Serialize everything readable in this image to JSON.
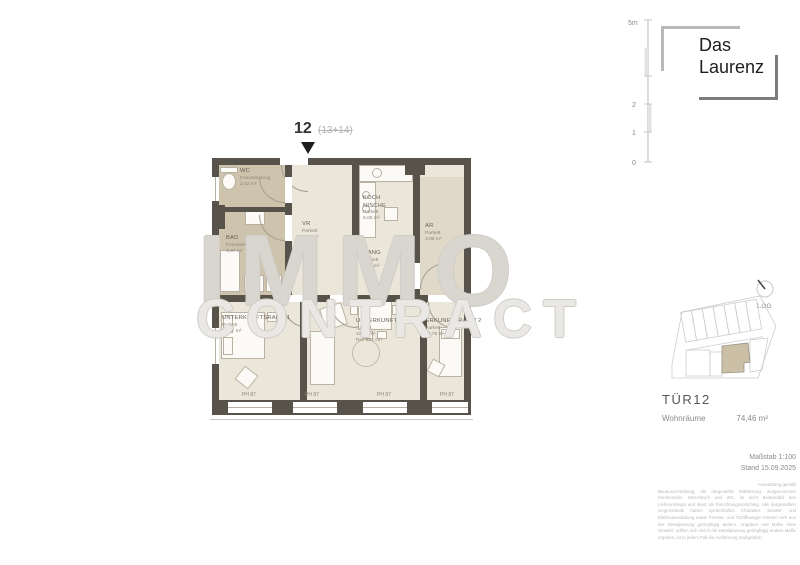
{
  "marker": {
    "unit": "12",
    "combined": "(13+14)"
  },
  "watermark": {
    "line1": "IMMO",
    "line2": "CONTRACT"
  },
  "scalebar": {
    "top_label": "5m",
    "label_2": "2",
    "label_1": "1",
    "label_0": "0"
  },
  "logo": {
    "line1": "Das",
    "line2": "Laurenz"
  },
  "floorplan": {
    "rooms": [
      {
        "name": "WC",
        "floor": "Feinsteinzeug",
        "area": "2,52 m²"
      },
      {
        "name": "BAD",
        "floor": "Feinsteinzeug",
        "area": "4,37 m²"
      },
      {
        "name": "VR",
        "floor": "Parkett",
        "area": "5,47 m²"
      },
      {
        "name": "KOCH NISCHE",
        "floor": "Parkett",
        "area": "6,05 m²"
      },
      {
        "name": "GANG",
        "floor": "Parkett",
        "area": "3,08 m²"
      },
      {
        "name": "AR",
        "floor": "Parkett",
        "area": "3,89 m²"
      },
      {
        "name": "UNTERKUNFTSRAUM 1",
        "floor": "Parkett",
        "area": "15,67 m²"
      },
      {
        "name": "UNTERKUNFTSRAUM 3",
        "floor": "Parkett",
        "area": "22,78 m²",
        "height": "RH: 321 cm"
      },
      {
        "name": "UNTERKUNFTSRAUM 2",
        "floor": "Parkett",
        "area": "10,75 m²"
      }
    ],
    "window_labels": [
      "PH 87",
      "PH 87",
      "PH 87",
      "PH 87"
    ]
  },
  "siteplan": {
    "floor_label": "1.OG"
  },
  "unit_info": {
    "title": "TÜR12",
    "area_label": "Wohnräume",
    "area_value": "74,46 m²"
  },
  "plan_meta": {
    "scale": "Maßstab 1:100",
    "date": "Stand 15.09.2025"
  },
  "disclaimer": {
    "intro": "Ausstattung gemäß",
    "body": "Bauausschreibung; die dargestellte Möblierung, ausgenommen Küchenzeile, Waschtisch und WC, ist nicht Bestandteil des Lieferumfangs und dient als Einrichtungsvorschlag. Alle dargestellten Gegenstände haben symbolhaften Charakter. Sanitär- und Elektroausstattung sowie Fenster- und Türöffnungen können sich aus der Detailplanung geringfügig ändern. Angaben und Maße ohne Gewähr; sollten sich durch die Detailplanung geringfügig andere Maße ergeben, ist in jedem Fall die Ausführung maßgeblich."
  },
  "colors": {
    "wall": "#57534b",
    "floor_main": "#ebe6da",
    "floor_tile": "#cec3ad",
    "floor_ar": "#e0d9c9",
    "unit_highlight": "#cbbfa5",
    "watermark": "#cfccc6",
    "muted_text": "#8d8679"
  }
}
